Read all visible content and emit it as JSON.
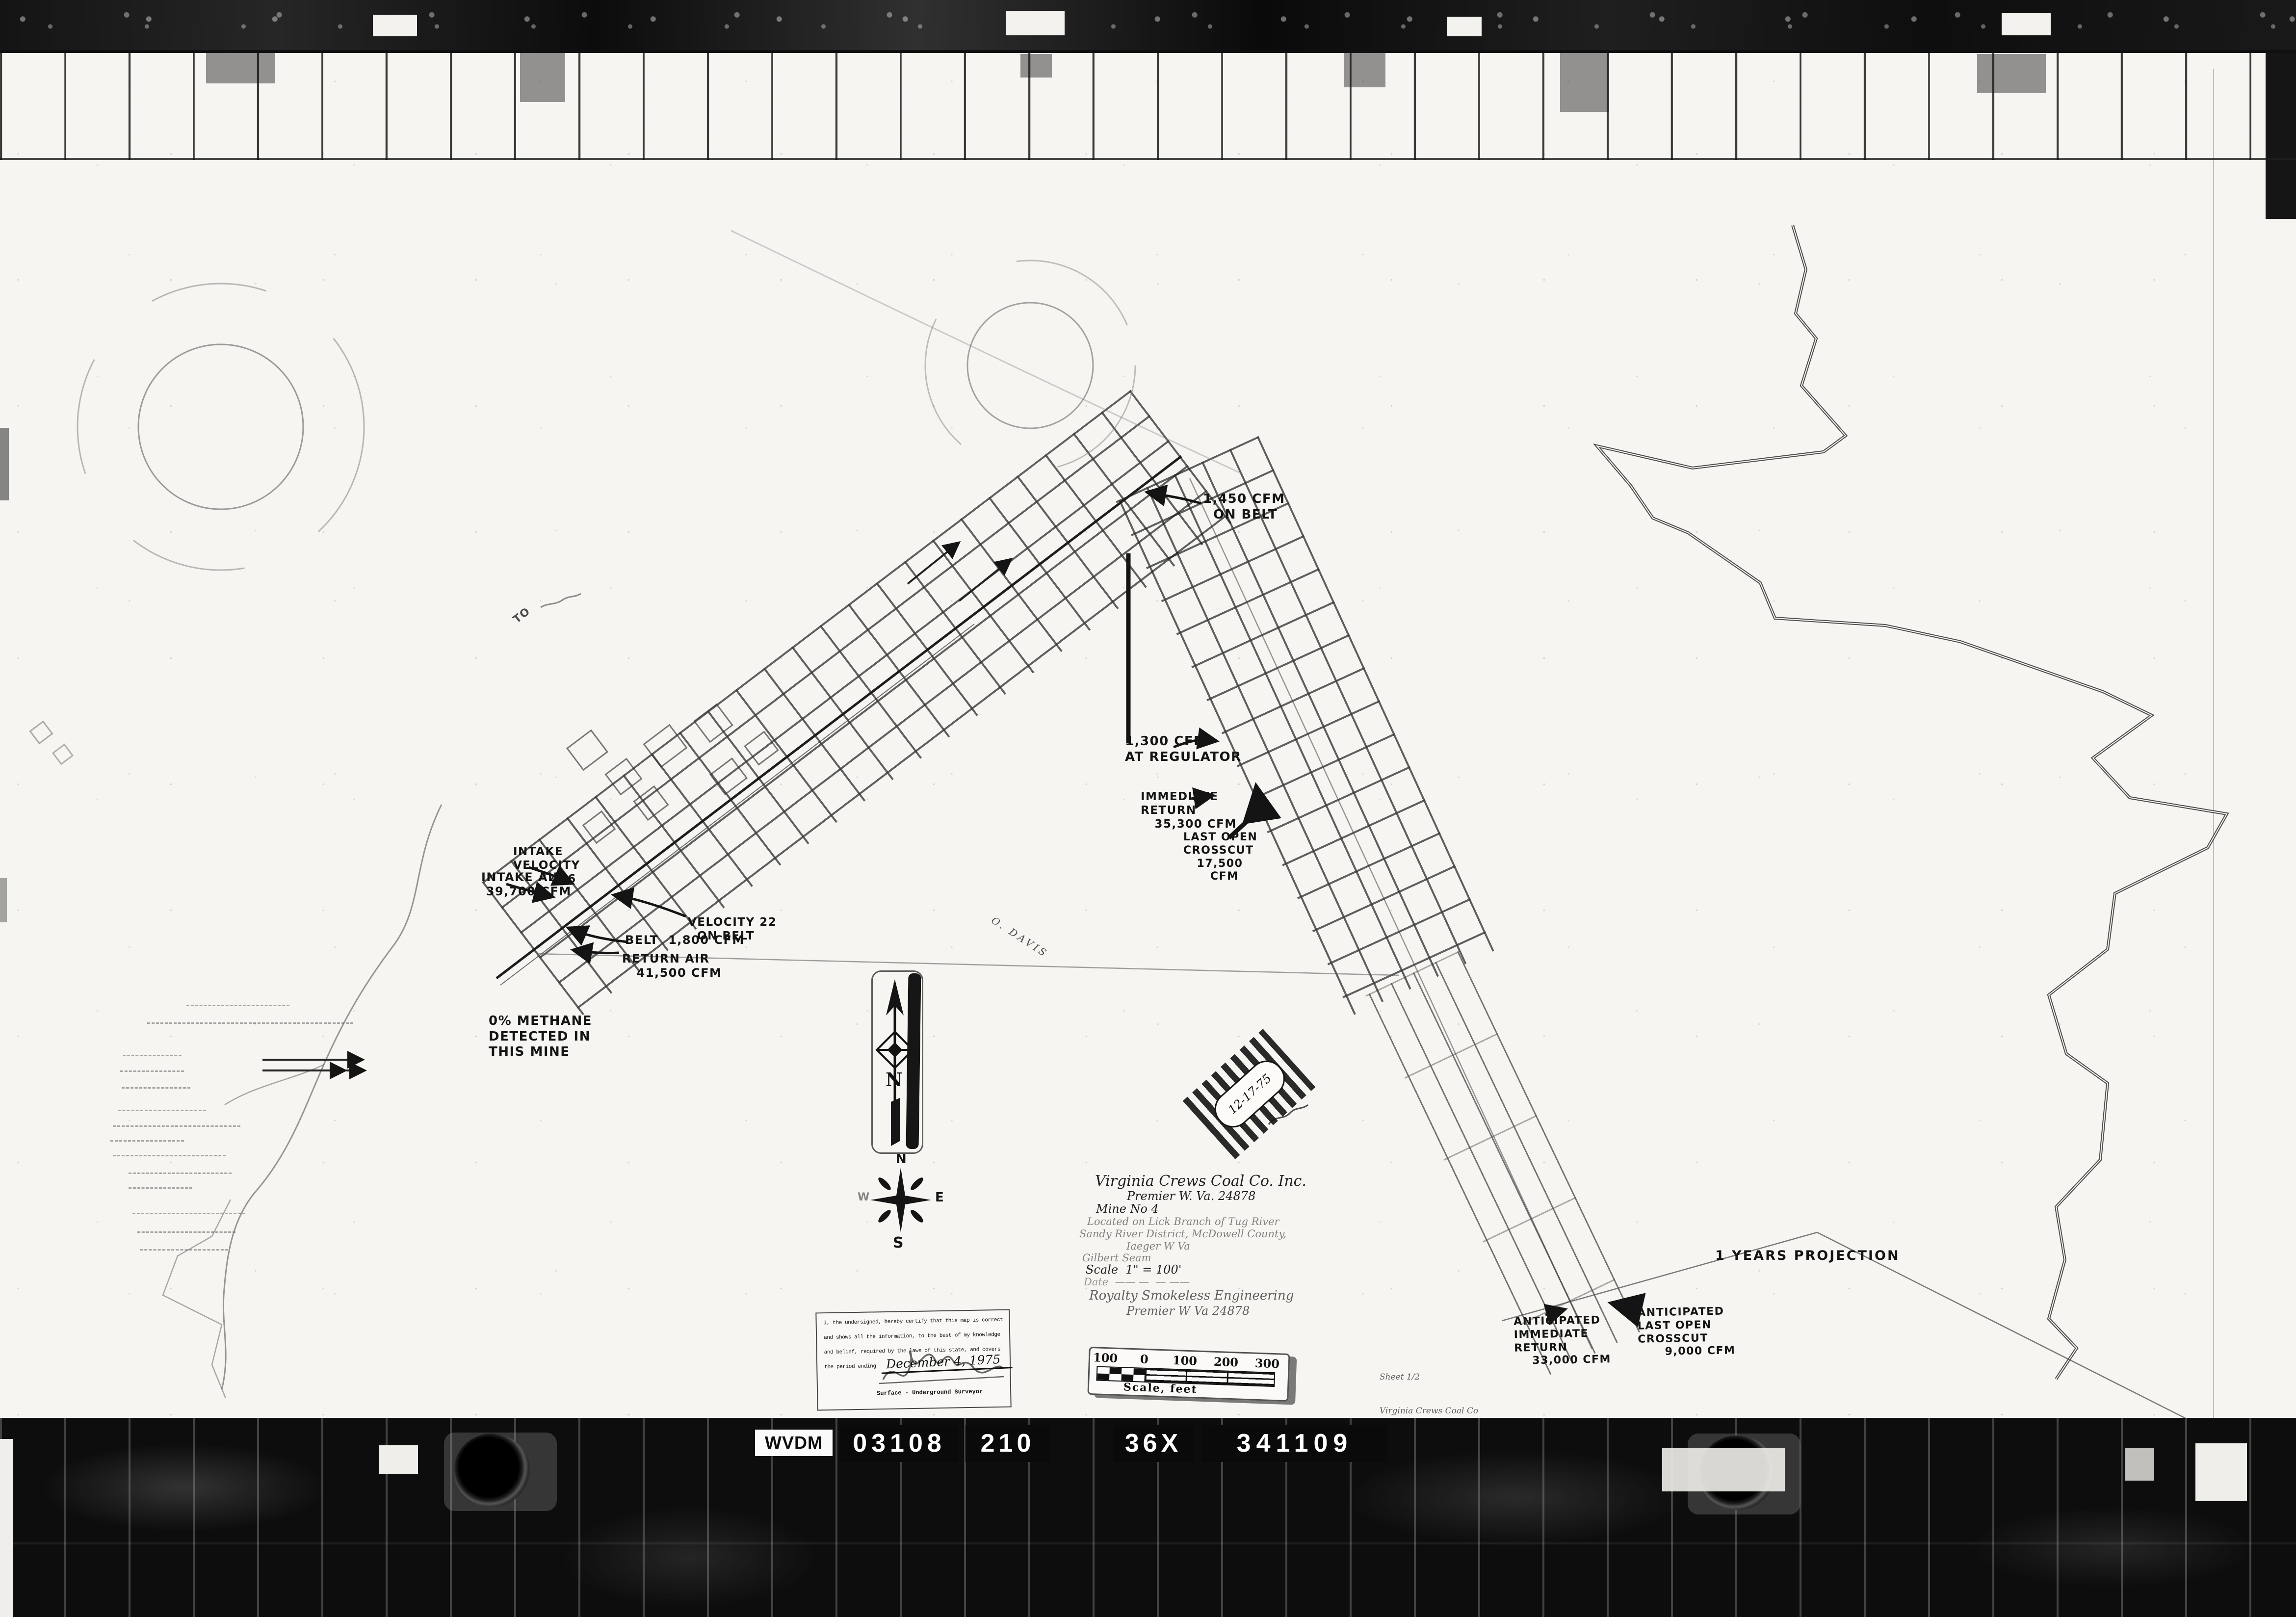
{
  "id_strip": {
    "prefix": "WVDM",
    "plates": [
      "03108",
      "210",
      "36X",
      "341109"
    ]
  },
  "annotations": {
    "belt_top": "1,450 CFM\n  ON BELT",
    "regulator": "1,300 CFM\nAT REGULATOR",
    "immediate_return": "IMMEDIATE\nRETURN\n   35,300 CFM",
    "last_open_crosscut": "LAST OPEN\nCROSSCUT\n   17,500\n      CFM",
    "intake_velocity": "INTAKE\nVELOCITY\n        496",
    "intake_air": "INTAKE AIR\n 39,700 CFM",
    "belt_velocity": "VELOCITY 22\n  ON BELT",
    "belt": "BELT  1,800 CFM",
    "return_air": "RETURN AIR\n   41,500 CFM",
    "methane": "0% METHANE\nDETECTED IN\nTHIS MINE",
    "anticipated_return": "ANTICIPATED\nIMMEDIATE\nRETURN\n    33,000 CFM",
    "anticipated_crosscut": "ANTICIPATED\nLAST OPEN\nCROSSCUT\n      9,000 CFM",
    "projection": "1 YEARS PROJECTION",
    "portal_to": "TO",
    "property_owner": "O. DAVIS"
  },
  "title_block": {
    "lines": [
      "Virginia Crews Coal Co. Inc.",
      "Premier W. Va. 24878",
      "Mine No 4",
      "Located on Lick Branch of Tug River",
      "Sandy River District, McDowell County,",
      "Iaeger W Va",
      "Gilbert Seam",
      "Scale  1\" = 100'",
      "Date  —— —  — ——",
      "Royalty Smokeless Engineering",
      "Premier W Va 24878"
    ]
  },
  "certification": {
    "l1": "I, the undersigned, hereby certify that this map is correct",
    "l2": "and shows all the information, to the best of my knowledge",
    "l3": "and belief, required by the laws of this state, and covers",
    "period_label": "the period ending",
    "date": "December 4, 1975",
    "signer_title": "Surface - Underground Surveyor"
  },
  "scale_bar": {
    "ticks": [
      "100",
      "0",
      "100",
      "200",
      "300"
    ],
    "caption": "Scale, feet"
  },
  "compass": {
    "n": "N",
    "e": "E",
    "s": "S",
    "w": "W"
  },
  "north": {
    "letter": "N"
  },
  "stamp": {
    "date": "12-17-75"
  },
  "sheet_note": {
    "lines": [
      "Sheet 1/2",
      "Virginia Crews Coal Co",
      "Mine No 4"
    ]
  }
}
